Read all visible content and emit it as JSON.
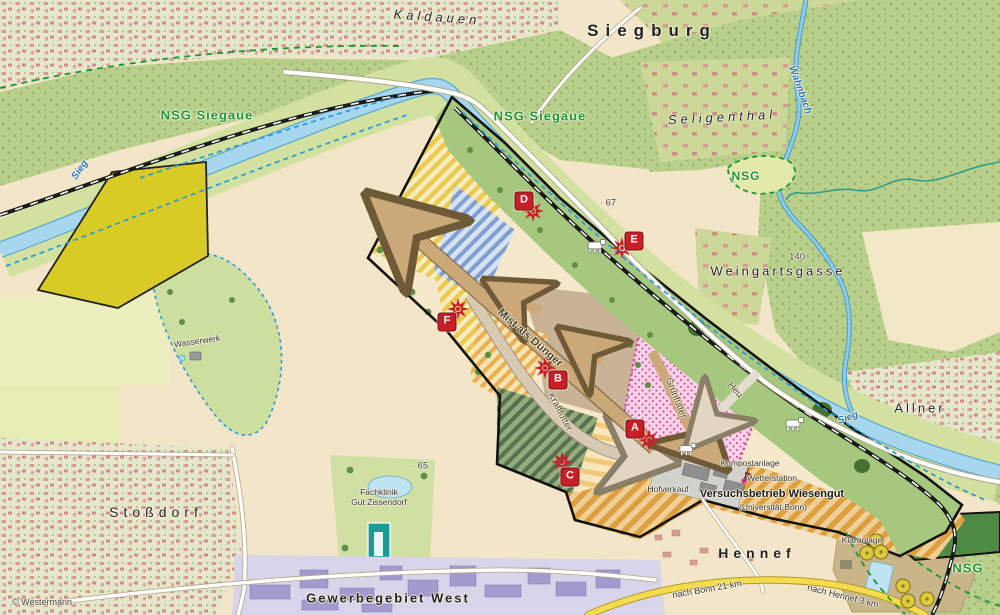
{
  "attribution": "© Westermann",
  "map_sheet_ref": "952 2",
  "places": {
    "kaldauen": "Kaldauen",
    "siegburg": "Siegburg",
    "seligenthal": "Seligenthal",
    "weingartsgasse": "Weingartsgasse",
    "allner": "Allner",
    "stossdorf": "Stoßdorf",
    "hennef": "Hennef",
    "gewerbegebiet_west": "Gewerbegebiet West"
  },
  "nature": {
    "nsg_siegaue_west": "NSG Siegaue",
    "nsg_siegaue_mid": "NSG Siegaue",
    "nsg_seligenthal": "NSG",
    "nsg_southeast": "NSG"
  },
  "water": {
    "sieg_upper": "Sieg",
    "sieg_lower": "Sieg",
    "wahnbach": "Wahnbach"
  },
  "elevations": {
    "pt_140": "140 ·",
    "pt_67": "· 67",
    "pt_65": "· 65"
  },
  "facilities": {
    "wasserwerk": "Wasserwerk",
    "fachklinik_line1": "Fachklinik",
    "fachklinik_line2": "Gut Zissendorf",
    "klaeranlage": "Kläranlage",
    "kompostanlage": "Kompostanlage",
    "wetterstation": "Wetterstation",
    "hofverkauf": "Hofverkauf"
  },
  "farm": {
    "name": "Versuchsbetrieb Wiesengut",
    "subtitle": "(Universität Bonn)"
  },
  "flows": {
    "mist": "Mist als Dünger",
    "kraftfutter": "Kraftfutter",
    "gruenfutter": "Grünfutter",
    "heu": "Heu"
  },
  "distances": {
    "bonn": "nach Bonn 21 km",
    "hennef": "nach Hennef 3 km"
  },
  "markers": {
    "a": "A",
    "b": "B",
    "c": "C",
    "d": "D",
    "e": "E",
    "f": "F"
  },
  "colors": {
    "marker_red": "#c81f27",
    "nsg_green": "#1f9433",
    "water_blue": "#a6d7ee",
    "water_text_blue": "#2778bc",
    "field_yellow": "#d9cb25",
    "arrow_brown": "#b59468",
    "road_yellow": "#f3dd4e"
  }
}
